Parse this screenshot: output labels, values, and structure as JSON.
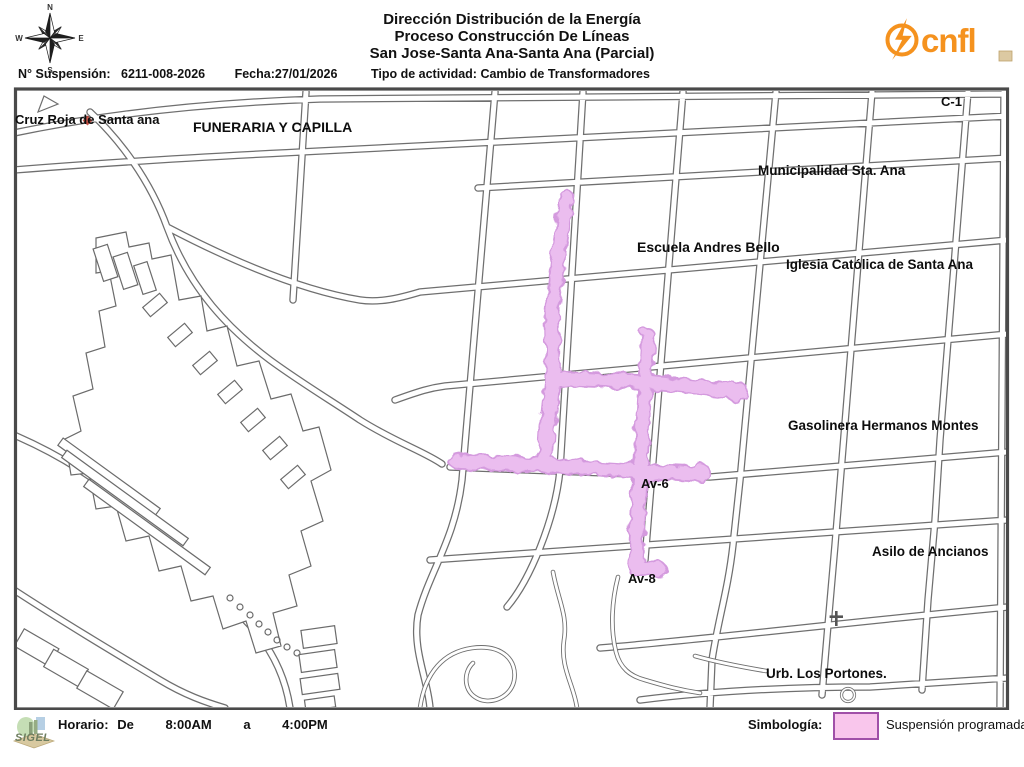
{
  "header": {
    "title_line1": "Dirección Distribución de la Energía",
    "title_line2": "Proceso Construcción De Líneas",
    "title_line3": "San Jose-Santa Ana-Santa Ana (Parcial)",
    "logo_text": "cnfl"
  },
  "info_bar": {
    "suspension_label": "N° Suspensión:",
    "suspension_value": "6211-008-2026",
    "fecha": "Fecha:27/01/2026",
    "tipo": "Tipo de actividad: Cambio de Transformadores"
  },
  "compass": {
    "n": "N",
    "e": "E",
    "s": "S",
    "w": "W"
  },
  "map": {
    "labels": [
      {
        "id": "c1",
        "text": "C-1"
      },
      {
        "id": "cruz-roja",
        "text": "Cruz Roja de Santa ana"
      },
      {
        "id": "funeraria",
        "text": "FUNERARIA Y CAPILLA"
      },
      {
        "id": "municipalidad",
        "text": "Municipalidad Sta. Ana"
      },
      {
        "id": "escuela",
        "text": "Escuela Andres Bello"
      },
      {
        "id": "iglesia",
        "text": "Iglesia Católica de Santa Ana"
      },
      {
        "id": "gasolinera",
        "text": "Gasolinera Hermanos Montes"
      },
      {
        "id": "av6",
        "text": "Av-6"
      },
      {
        "id": "asilo",
        "text": "Asilo de Ancianos"
      },
      {
        "id": "av8",
        "text": "Av-8"
      },
      {
        "id": "urb",
        "text": "Urb. Los Portones."
      }
    ]
  },
  "footer": {
    "sigel_text": "SIGEL",
    "horario_label": "Horario:",
    "de": "De",
    "start_time": "8:00AM",
    "a": "a",
    "end_time": "4:00PM",
    "simbologia_label": "Simbología:",
    "legend_text": "Suspensión programada"
  },
  "colors": {
    "cnfl_orange": "#F5921E",
    "street_gray": "#6F6F6F",
    "suspension_fill": "#EBBDEF",
    "suspension_edge": "#D49ADE",
    "legend_fill": "#F9C6EC",
    "legend_border": "#A050A8",
    "map_border": "#4A4A4A"
  }
}
